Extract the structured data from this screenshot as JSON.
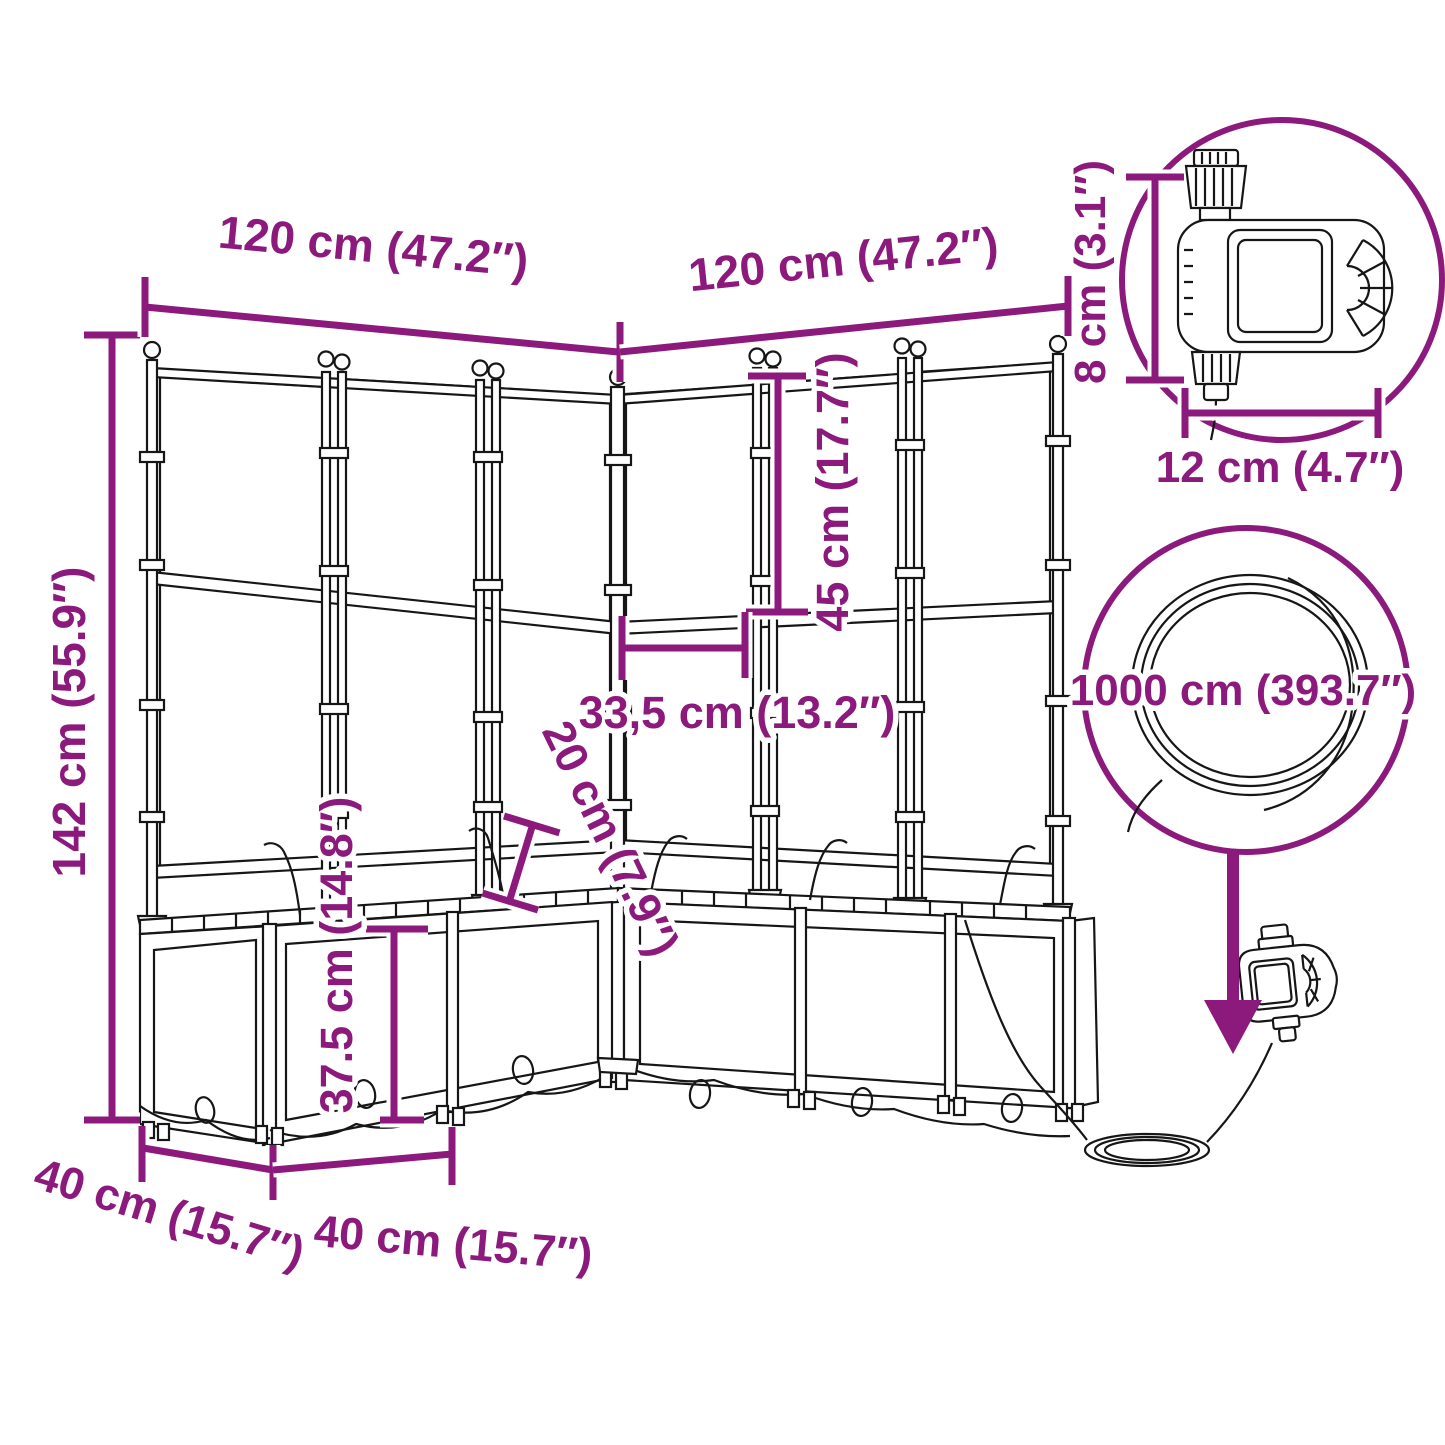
{
  "figure": {
    "type": "product dimension diagram",
    "subject": "corner garden planter with trellis and automatic irrigation (timer + hose)"
  },
  "colors": {
    "dimension": "#8c1a7c",
    "drawing": "#161616",
    "background": "#ffffff"
  },
  "dimensions": {
    "top_left_width": "120 cm (47.2″)",
    "top_right_width": "120 cm (47.2″)",
    "total_height": "142 cm (55.9″)",
    "upper_trellis_height": "45 cm (17.7″)",
    "panel_spacing": "33,5 cm (13.2″)",
    "drip_tube_height": "20 cm (7.9″)",
    "planter_height": "37.5 cm (14.8″)",
    "side_depth": "40 cm (15.7″)",
    "front_module_width": "40 cm (15.7″)",
    "timer_height": "8 cm (3.1″)",
    "timer_width": "12 cm (4.7″)",
    "hose_length": "1000 cm (393.7″)"
  }
}
